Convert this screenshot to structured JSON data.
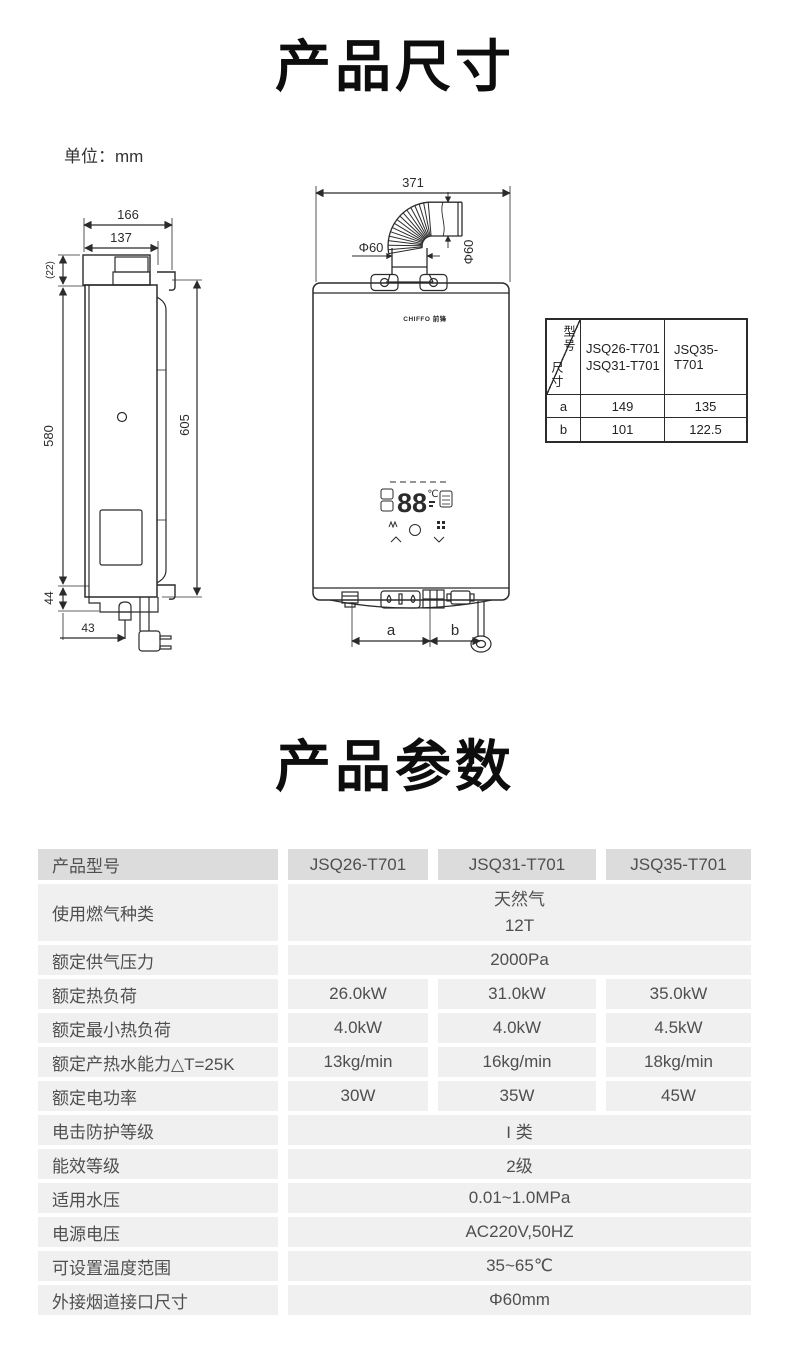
{
  "sections": {
    "dimensions_title": "产品尺寸",
    "unit_label": "单位：mm",
    "params_title": "产品参数"
  },
  "drawing": {
    "brand_logo": "CHIFFO 前锋",
    "display_digits": "88",
    "display_celsius": "℃",
    "side_view": {
      "dim_depth_total": "166",
      "dim_depth_body": "137",
      "dim_cap_height": "(22)",
      "dim_body_height": "580",
      "dim_mount_height": "605",
      "dim_bottom_height": "44",
      "dim_bottom_offset": "43"
    },
    "front_view": {
      "dim_total_width": "371",
      "dim_flue_diameter_left": "Φ60",
      "dim_flue_diameter_right": "Φ60",
      "dim_a_label": "a",
      "dim_b_label": "b"
    },
    "size_table": {
      "corner_model_label": "型号",
      "corner_size_label": "尺寸",
      "col_models_a": [
        "JSQ26-T701",
        "JSQ31-T701"
      ],
      "col_model_b": "JSQ35-T701",
      "rows": [
        {
          "dim": "a",
          "value_a": "149",
          "value_b": "135"
        },
        {
          "dim": "b",
          "value_a": "101",
          "value_b": "122.5"
        }
      ]
    }
  },
  "spec_table": {
    "header": {
      "label": "产品型号",
      "model1": "JSQ26-T701",
      "model2": "JSQ31-T701",
      "model3": "JSQ35-T701"
    },
    "rows": [
      {
        "label": "使用燃气种类",
        "merged_lines": [
          "天然气",
          "12T"
        ]
      },
      {
        "label": "额定供气压力",
        "merged": "2000Pa"
      },
      {
        "label": "额定热负荷",
        "values": [
          "26.0kW",
          "31.0kW",
          "35.0kW"
        ]
      },
      {
        "label": "额定最小热负荷",
        "values": [
          "4.0kW",
          "4.0kW",
          "4.5kW"
        ]
      },
      {
        "label": "额定产热水能力△T=25K",
        "values": [
          "13kg/min",
          "16kg/min",
          "18kg/min"
        ]
      },
      {
        "label": "额定电功率",
        "values": [
          "30W",
          "35W",
          "45W"
        ]
      },
      {
        "label": "电击防护等级",
        "merged": "I 类"
      },
      {
        "label": "能效等级",
        "merged": "2级"
      },
      {
        "label": "适用水压",
        "merged": "0.01~1.0MPa"
      },
      {
        "label": "电源电压",
        "merged": "AC220V,50HZ"
      },
      {
        "label": "可设置温度范围",
        "merged": "35~65℃"
      },
      {
        "label": "外接烟道接口尺寸",
        "merged": "Φ60mm"
      }
    ]
  },
  "colors": {
    "spec_header_bg": "#dcdcdc",
    "spec_row_bg": "#f0f0f0",
    "spec_text": "#4f4f4f",
    "line_color": "#2b2b2b"
  }
}
